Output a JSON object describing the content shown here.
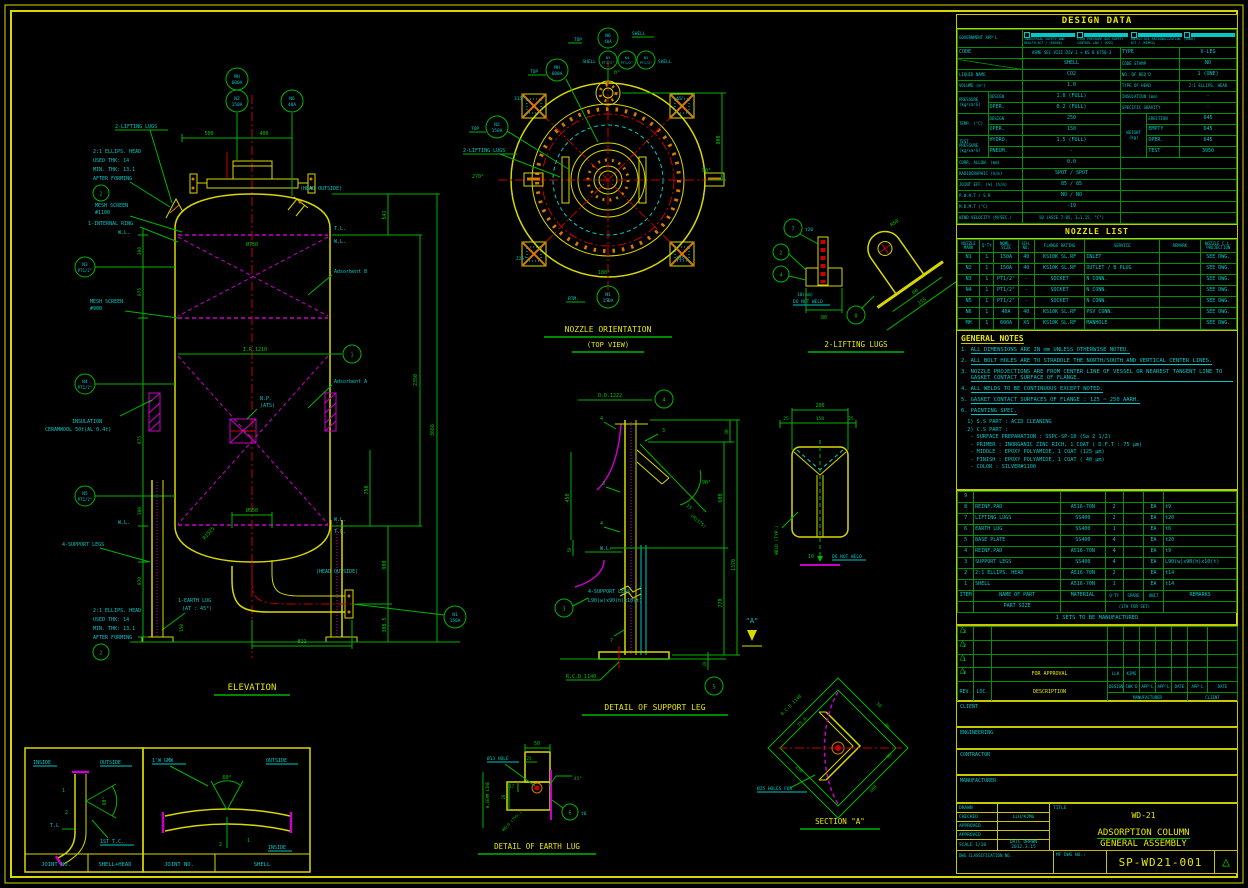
{
  "colors": {
    "yellow": "#d8d800",
    "green": "#00b400",
    "cyan": "#00c8c8",
    "magenta": "#c800c8",
    "red": "#c80000",
    "orange": "#d87800"
  },
  "design_data": {
    "title": "DESIGN DATA",
    "gov_label": "GOVERNMENT APP'L",
    "gov_items": [
      "INDUSTRIAL SAFETY AND HEALTH ACT / (KOSHA)",
      "HIGH PRESSURE GAS SAFETY CONTROL LAW / (KGS)",
      "ENERGY USE RATIONALIZATION ACT / (KEMCO)",
      "(NONE)"
    ],
    "code_label": "CODE",
    "code": "ASME SEC-VIII DIV.1 + KS B 6750-3",
    "type_label": "TYPE",
    "type": "V-LEG",
    "shell": "SHELL",
    "stamp_label": "CODE STAMP",
    "stamp": "NO",
    "liquid_label": "LIQUID NAME",
    "liquid": "CO2",
    "reqd_label": "NO. OF REQ'D",
    "reqd": "1 (ONE)",
    "volume_label": "VOLUME (m³)",
    "volume": "1.0",
    "head_label": "TYPE OF HEAD",
    "head": "2:1 ELLIPS. HEAD",
    "pressure_label": "PRESSURE (kg/cm²G)",
    "design_label": "DESIGN",
    "oper_label": "OPER.",
    "p_design": "1.0 (FULL)",
    "p_oper": "0.2 (FULL)",
    "insul_label": "INSULATION (mm)",
    "insul": "-",
    "sg_label": "SPECIFIC GRAVITY",
    "sg": "-",
    "temp_label": "TEMP. (°C)",
    "t_design": "250",
    "t_oper": "150",
    "weight_label": "WEIGHT (kg)",
    "erection_label": "ERECTION",
    "empty_label": "EMPTY",
    "woper_label": "OPER.",
    "wtest_label": "TEST",
    "w_erection": "645",
    "w_empty": "645",
    "w_oper": "645",
    "w_test": "3950",
    "test_label": "TEST PRESSURE (kg/cm²G)",
    "hydro_label": "HYDRO.",
    "pneum_label": "PNEUM.",
    "hydro": "1.5 (FULL)",
    "pneum": "-",
    "corr_label": "CORR. ALLOW. (mm)",
    "corr": "0.0",
    "radio_label": "RADIOGRAPHIC (h/m)",
    "radio": "SPOT / SPOT",
    "joint_label": "JOINT EFF. (%) (h/m)",
    "joint": "85 / 85",
    "pwht_label": "P.W.H.T / S.R",
    "pwht": "NO / NO",
    "mdmt_label": "M.D.M.T (°C)",
    "mdmt": "-19",
    "wind_label": "WIND VELOCITY (M/SEC.)",
    "wind": "50 (ASCE 7-05, I=1.15, \"C\")",
    "quake_label": "EARTHQUAKE FACTOR",
    "quake": "UBC97 ZONE \"2B\", I=1.25, \"SD\""
  },
  "nozzle_list": {
    "title": "NOZZLE LIST",
    "headers": [
      "NOZZLE MARK",
      "Q'TY",
      "NOML. SIZE",
      "SCH. NO.",
      "FLANGE RATING",
      "SERVICE",
      "REMARK",
      "NOZZLE C.L. PROJECTION"
    ],
    "rows": [
      {
        "mark": "N1",
        "qty": "1",
        "size": "150A",
        "sch": "40",
        "flange": "KS10K SL.RF",
        "service": "INLET",
        "remark": "",
        "proj": "SEE DWG."
      },
      {
        "mark": "N2",
        "qty": "1",
        "size": "150A",
        "sch": "40",
        "flange": "KS10K SL.RF",
        "service": "OUTLET / B PLUG",
        "remark": "",
        "proj": "SEE DWG."
      },
      {
        "mark": "N3",
        "qty": "1",
        "size": "PT1/2\"",
        "sch": "-",
        "flange": "SOCKET",
        "service": "N CONN.",
        "remark": "",
        "proj": "SEE DWG."
      },
      {
        "mark": "N4",
        "qty": "1",
        "size": "PT1/2\"",
        "sch": "-",
        "flange": "SOCKET",
        "service": "N CONN.",
        "remark": "",
        "proj": "SEE DWG."
      },
      {
        "mark": "N5",
        "qty": "1",
        "size": "PT1/2\"",
        "sch": "-",
        "flange": "SOCKET",
        "service": "N CONN.",
        "remark": "",
        "proj": "SEE DWG."
      },
      {
        "mark": "N6",
        "qty": "1",
        "size": "40A",
        "sch": "40",
        "flange": "KS10K SL.RF",
        "service": "PSV CONN.",
        "remark": "",
        "proj": "SEE DWG."
      },
      {
        "mark": "MH",
        "qty": "1",
        "size": "600A",
        "sch": "XS",
        "flange": "KS10K SL.RF",
        "service": "MANHOLE",
        "remark": "",
        "proj": "SEE DWG."
      }
    ]
  },
  "general_notes": {
    "title": "GENERAL NOTES",
    "items": [
      {
        "no": "1.",
        "text": "ALL DIMENSIONS ARE IN mm UNLESS OTHERWISE NOTED."
      },
      {
        "no": "2.",
        "text": "ALL BOLT HOLES ARE TO STRADDLE THE NORTH/SOUTH AND VERTICAL CENTER LINES."
      },
      {
        "no": "3.",
        "text": "NOZZLE PROJECTIONS ARE FROM CENTER LINE OF VESSEL OR NEAREST TANGENT LINE TO GASKET CONTACT SURFACE OF FLANGE."
      },
      {
        "no": "4.",
        "text": "ALL WELDS TO BE CONTINUOUS EXCEPT NOTED."
      },
      {
        "no": "5.",
        "text": "GASKET CONTACT SURFACES OF FLANGE : 125 ~ 250 AARH."
      },
      {
        "no": "6.",
        "text": "PAINTING SPEC."
      }
    ],
    "painting": [
      "  1) S.S PART : ACID CLEANING",
      "  2) C.S PART :",
      "   - SURFACE PREPARATION : SSPC-SP-10 (Sa 2 1/2)",
      "   - PRIMER : INORGANIC ZINC RICH, 1 COAT ( D.F.T : 75 µm)",
      "   - MIDDLE : EPOXY POLYAMIDE, 1 COAT (125 µm)",
      "   - FINISH : EPOXY POLYAMIDE, 1 COAT ( 40 µm)",
      "   - COLOR : SILVER#1100"
    ]
  },
  "bom": {
    "rows": [
      {
        "item": "9",
        "name": "",
        "material": "",
        "qty": "",
        "spare": "",
        "unit": "",
        "remarks": ""
      },
      {
        "item": "8",
        "name": "REINF.PAD",
        "material": "A516-70N",
        "qty": "2",
        "spare": "",
        "unit": "EA",
        "remarks": "t9"
      },
      {
        "item": "7",
        "name": "LIFTING LUGS",
        "material": "SS400",
        "qty": "2",
        "spare": "",
        "unit": "EA",
        "remarks": "t20"
      },
      {
        "item": "6",
        "name": "EARTH LUG",
        "material": "SS400",
        "qty": "1",
        "spare": "",
        "unit": "EA",
        "remarks": "t6"
      },
      {
        "item": "5",
        "name": "BASE PLATE",
        "material": "SS400",
        "qty": "4",
        "spare": "",
        "unit": "EA",
        "remarks": "t20"
      },
      {
        "item": "4",
        "name": "REINF.PAD",
        "material": "A516-70N",
        "qty": "4",
        "spare": "",
        "unit": "EA",
        "remarks": "t9"
      },
      {
        "item": "3",
        "name": "SUPPORT LEGS",
        "material": "SS400",
        "qty": "4",
        "spare": "",
        "unit": "EA",
        "remarks": "L90(w)x90(h)x10(t)"
      },
      {
        "item": "2",
        "name": "2:1 ELLIPS. HEAD",
        "material": "A516-70N",
        "qty": "2",
        "spare": "",
        "unit": "EA",
        "remarks": "t14"
      },
      {
        "item": "1",
        "name": "SHELL",
        "material": "A516-70N",
        "qty": "1",
        "spare": "",
        "unit": "EA",
        "remarks": "t14"
      }
    ],
    "footer": {
      "item": "ITEM",
      "name": "NAME OF PART",
      "name2": "PART SIZE",
      "material": "MATERIAL",
      "qty": "Q'TY",
      "spare": "SPARE",
      "unit": "UNIT",
      "qty2": "(1TH FOR SET)",
      "remarks": "REMARKS"
    },
    "note": "1 SETS TO BE MANUFACTURED"
  },
  "revisions": {
    "rows": [
      {
        "rev": "3",
        "loc": "",
        "desc": "",
        "design": "",
        "chkd": "",
        "appl1": "",
        "appl2": "",
        "date1": "",
        "appl3": "",
        "date2": ""
      },
      {
        "rev": "2",
        "loc": "",
        "desc": "",
        "design": "",
        "chkd": "",
        "appl1": "",
        "appl2": "",
        "date1": "",
        "appl3": "",
        "date2": ""
      },
      {
        "rev": "1",
        "loc": "",
        "desc": "",
        "design": "",
        "chkd": "",
        "appl1": "",
        "appl2": "",
        "date1": "",
        "appl3": "",
        "date2": ""
      },
      {
        "rev": "0",
        "loc": "",
        "desc": "FOR APPROVAL",
        "design": "LLH",
        "chkd": "KJMG",
        "appl1": "",
        "appl2": "",
        "date1": "",
        "appl3": "",
        "date2": ""
      }
    ],
    "h": {
      "rev": "REV.",
      "loc": "LOC.",
      "desc": "DESCRIPTION",
      "design": "DESIGN",
      "chkd": "CHK'D",
      "appl": "APP'L",
      "date": "DATE",
      "manufacturer": "MANUFACTURER",
      "client": "CLIENT"
    }
  },
  "sections": {
    "client": "CLIENT",
    "engineering": "ENGINEERING",
    "contractor": "CONTRACTOR",
    "manufacturer": "MANUFACTURER"
  },
  "title_block": {
    "drawn_label": "DRAWN",
    "checked_label": "CHECKED",
    "checked": "LLH/KJMG",
    "approved_label": "APPROVED",
    "approved2_label": "APPROVED",
    "scale_label": "SCALE",
    "scale": "1/10",
    "date_label": "DATE DRAWN",
    "date": "2012.3.15",
    "class_label": "DWG CLASSIFICATION NO.",
    "title_label": "TITLE",
    "title_line1": "WD-21",
    "title_line2": "ADSORPTION COLUMN",
    "title_line3": "GENERAL ASSEMBLY",
    "dwg_no_label": "MF DWG NO.:",
    "dwg_no": "SP-WD21-001"
  },
  "lbl": {
    "elevation_title": "ELEVATION",
    "orientation_title": "NOZZLE ORIENTATION",
    "orientation_sub": "(TOP VIEW)",
    "lifting_lugs_title": "2-LIFTING LUGS",
    "support_leg_title": "DETAIL OF SUPPORT LEG",
    "earth_lug_title": "DETAIL OF EARTH LUG",
    "section_a_title": "SECTION \"A\"",
    "lifting_lugs": "2-LIFTING LUGS",
    "head_note_1": "2:1 ELLIPS. HEAD",
    "head_note_2": "USED THK: 14",
    "head_note_3": "MIN. THK: 13.1",
    "head_note_4": "AFTER FORMING",
    "mesh_screen": "MESH SCREEN",
    "mesh_1100": "#1100",
    "mesh_900": "#900",
    "internal_ring": "1-INTERNAL RING",
    "insulation_1": "INSULATION",
    "insulation_2": "CERAMWOOL 50t(AL 0.4t)",
    "adsorbent_a": "Adsorbent A",
    "adsorbent_b": "Adsorbent B",
    "np": "N.P.",
    "np_2": "(ATS)",
    "support_legs": "4-SUPPORT LEGS",
    "leg_spec": "L90(w)x90(h)x10(t)",
    "earth_lug_1": "1-EARTH LUG",
    "earth_lug_2": "(AT : 45°)",
    "head_outside": "(HEAD OUTSIDE)",
    "wl": "W.L.",
    "tl": "T.L.",
    "ir_1210": "I.R.1210",
    "top": "TOP",
    "btm": "BTM.",
    "shell": "SHELL",
    "mh": "MH",
    "mh_size": "600A",
    "n1": "N1",
    "n1_size": "150A",
    "n2": "N2",
    "n2_size": "150A",
    "n3": "N3",
    "n4": "N4",
    "n5": "N5",
    "pt_half": "PT1/2\"",
    "n6": "N6",
    "n6_size": "40A",
    "deg0": "0°",
    "deg45": "45°",
    "deg90": "90°",
    "deg135": "135°",
    "deg180": "180°",
    "deg225": "225°",
    "deg270": "270°",
    "deg315": "315°",
    "d500": "500",
    "d400": "400",
    "d800": "800",
    "d811": "811",
    "d541": "541",
    "d2350": "2350",
    "d3666": "3666",
    "d900": "900",
    "d3085": "308.5",
    "d750": "750",
    "d200": "200",
    "d875": "875",
    "d870": "870",
    "d300": "300",
    "d150": "150",
    "phi750": "Ø750",
    "phi550": "Ø550",
    "r1525": "R1525",
    "t20": "t20",
    "d80": "80",
    "d60": "60",
    "d155": "155",
    "r50": "R50",
    "dnw_10mm": "10(mm)",
    "do_not_weld": "DO NOT WELD",
    "od1222": "O.D.1222",
    "d450": "450",
    "d50": "50",
    "d30": "30",
    "d600": "600",
    "d1370": "1370",
    "d770": "770",
    "d15": "15",
    "r1375": "(R1375)",
    "rcd1140": "R.C.D 1140",
    "d20": "20",
    "a_mark": "\"A\"",
    "d25": "25",
    "d10": "10",
    "weld_typ": "WELD (TYP.)",
    "b200": "200",
    "b150": "150",
    "el_50": "50",
    "el_25": "25",
    "el_17": "17",
    "el_28": "28",
    "phi13": "Ø13 HOLE",
    "t6": "t6",
    "wseam": "W.SEAM LINE",
    "bcd1140": "B.C.D 1140",
    "phi25_holes": "Ø25 HOLES FOR",
    "d756": "75.6",
    "d90": "90",
    "d180": "180",
    "inside": "INSIDE",
    "outside": "OUTSIDE",
    "deg60": "60°",
    "j1": "1",
    "j2": "2",
    "jtl": "T.L",
    "first_tc": "1ST T.C.",
    "gmw": "1'W GMW",
    "joint_no": "JOINT NO.",
    "shell_head": "SHELL+HEAD",
    "b1": "1",
    "b2": "2",
    "b3": "3",
    "b4": "4",
    "b5": "5",
    "b6": "6",
    "b7": "7",
    "b8": "8",
    "w3": "3",
    "w4": "4",
    "w7": "7"
  }
}
